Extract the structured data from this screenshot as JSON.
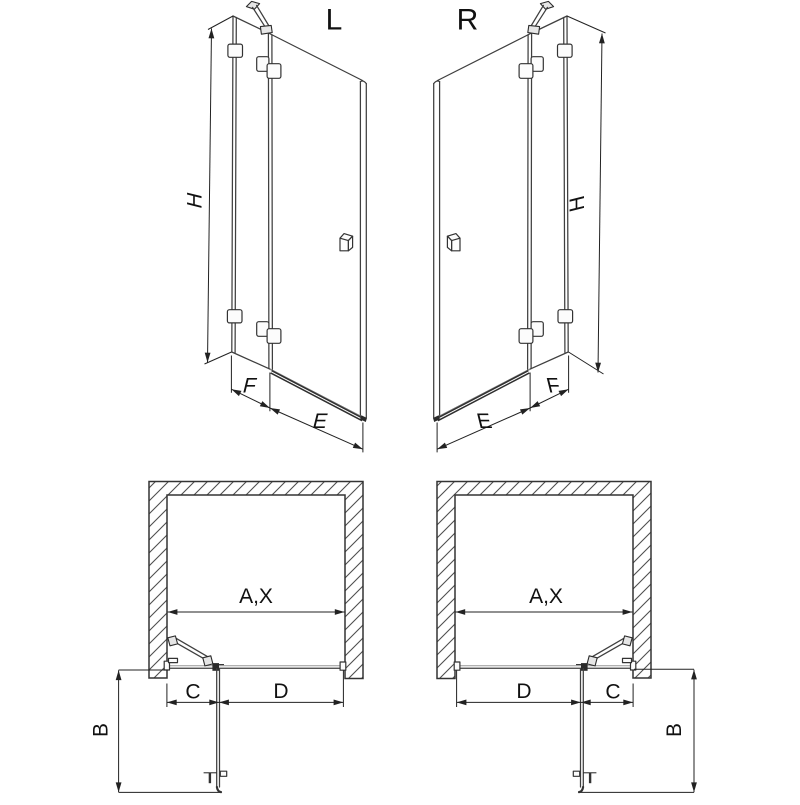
{
  "colors": {
    "background": "#ffffff",
    "line": "#3f3f3f",
    "dim_line": "#222222",
    "text": "#111111",
    "dark_fill": "#2b2b2b"
  },
  "elevation_left": {
    "variant": "L",
    "height": "H",
    "fixed_panel_width": "F",
    "door_width": "E"
  },
  "elevation_right": {
    "variant": "R",
    "height": "H",
    "fixed_panel_width": "F",
    "door_width": "E"
  },
  "plan_left": {
    "niche_width": "A,X",
    "door_swing_depth": "B",
    "fixed_panel_segment": "C",
    "door_segment": "D"
  },
  "plan_right": {
    "niche_width": "A,X",
    "door_swing_depth": "B",
    "fixed_panel_segment": "C",
    "door_segment": "D"
  }
}
